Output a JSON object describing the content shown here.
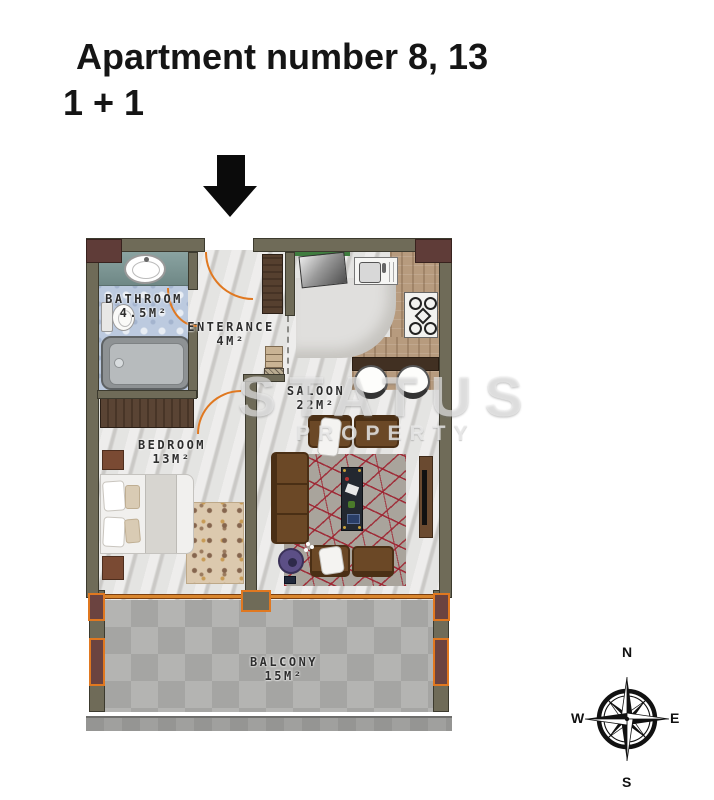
{
  "header": {
    "title_line1": "Apartment number 8, 13",
    "title_line2": "1 + 1"
  },
  "floor_plan": {
    "rooms": [
      {
        "name": "BATHROOM",
        "area": "4.5M²"
      },
      {
        "name": "ENTERANCE",
        "area": "4M²"
      },
      {
        "name": "SALOON",
        "area": "22M²"
      },
      {
        "name": "BEDROOM",
        "area": "13M²"
      },
      {
        "name": "BALCONY",
        "area": "15M²"
      }
    ],
    "watermark": {
      "line1": "STATUS",
      "line2": "PROPERTY"
    }
  },
  "compass": {
    "north": "N",
    "east": "E",
    "south": "S",
    "west": "W"
  },
  "colors": {
    "wall_olive": "#6f6b58",
    "corner_maroon": "#5f3c38",
    "door_orange": "#e07820",
    "bath_tile": "#bccadf",
    "sofa_brown": "#6b4826",
    "rug_line_red": "#9e202e",
    "balcony_tile": "#b0b0ae"
  }
}
